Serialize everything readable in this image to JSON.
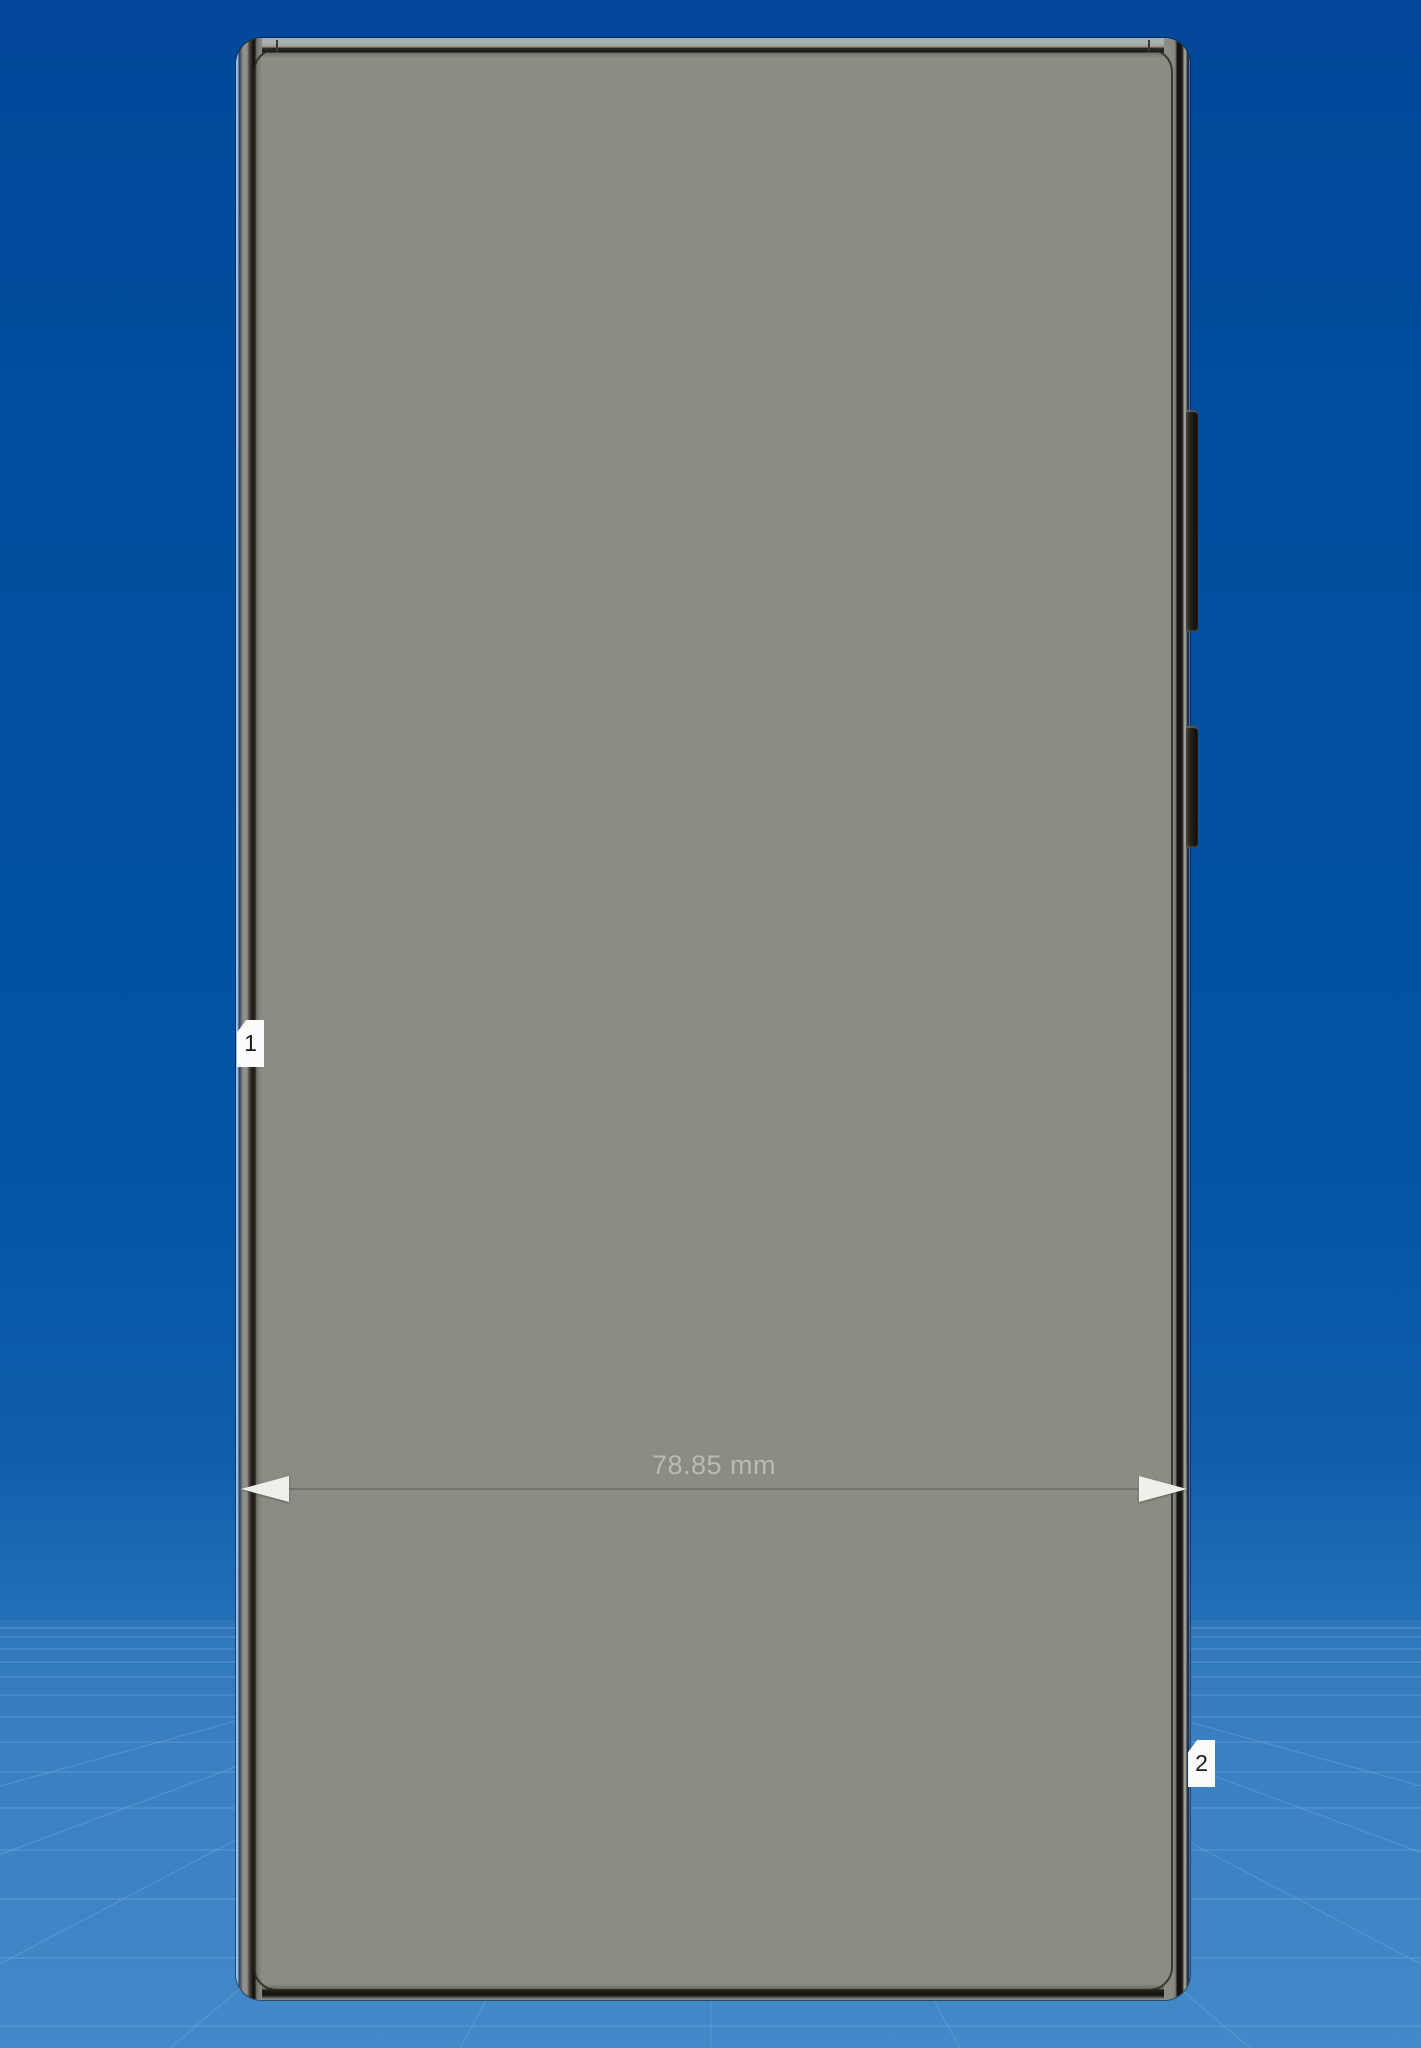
{
  "scene": {
    "type": "cad-3d-viewport",
    "model_name": "phone-front-view",
    "dimension_label": "78.85 mm",
    "markers": [
      {
        "label": "1"
      },
      {
        "label": "2"
      }
    ],
    "colors": {
      "sky_top": "#03489a",
      "sky_bottom": "#2470b8",
      "ground_top": "#2e76bb",
      "ground_bottom": "#4189c9",
      "grid_line": "#8cbbe6",
      "model_body": "#8b8d85",
      "model_frame_light": "#a8aaa2",
      "model_outline": "#23231f",
      "dimension_text": "#b9bbb2",
      "arrow_fill": "#eef0ea",
      "tag_background": "#fbfbf9",
      "tag_text": "#1d1d1b"
    }
  }
}
